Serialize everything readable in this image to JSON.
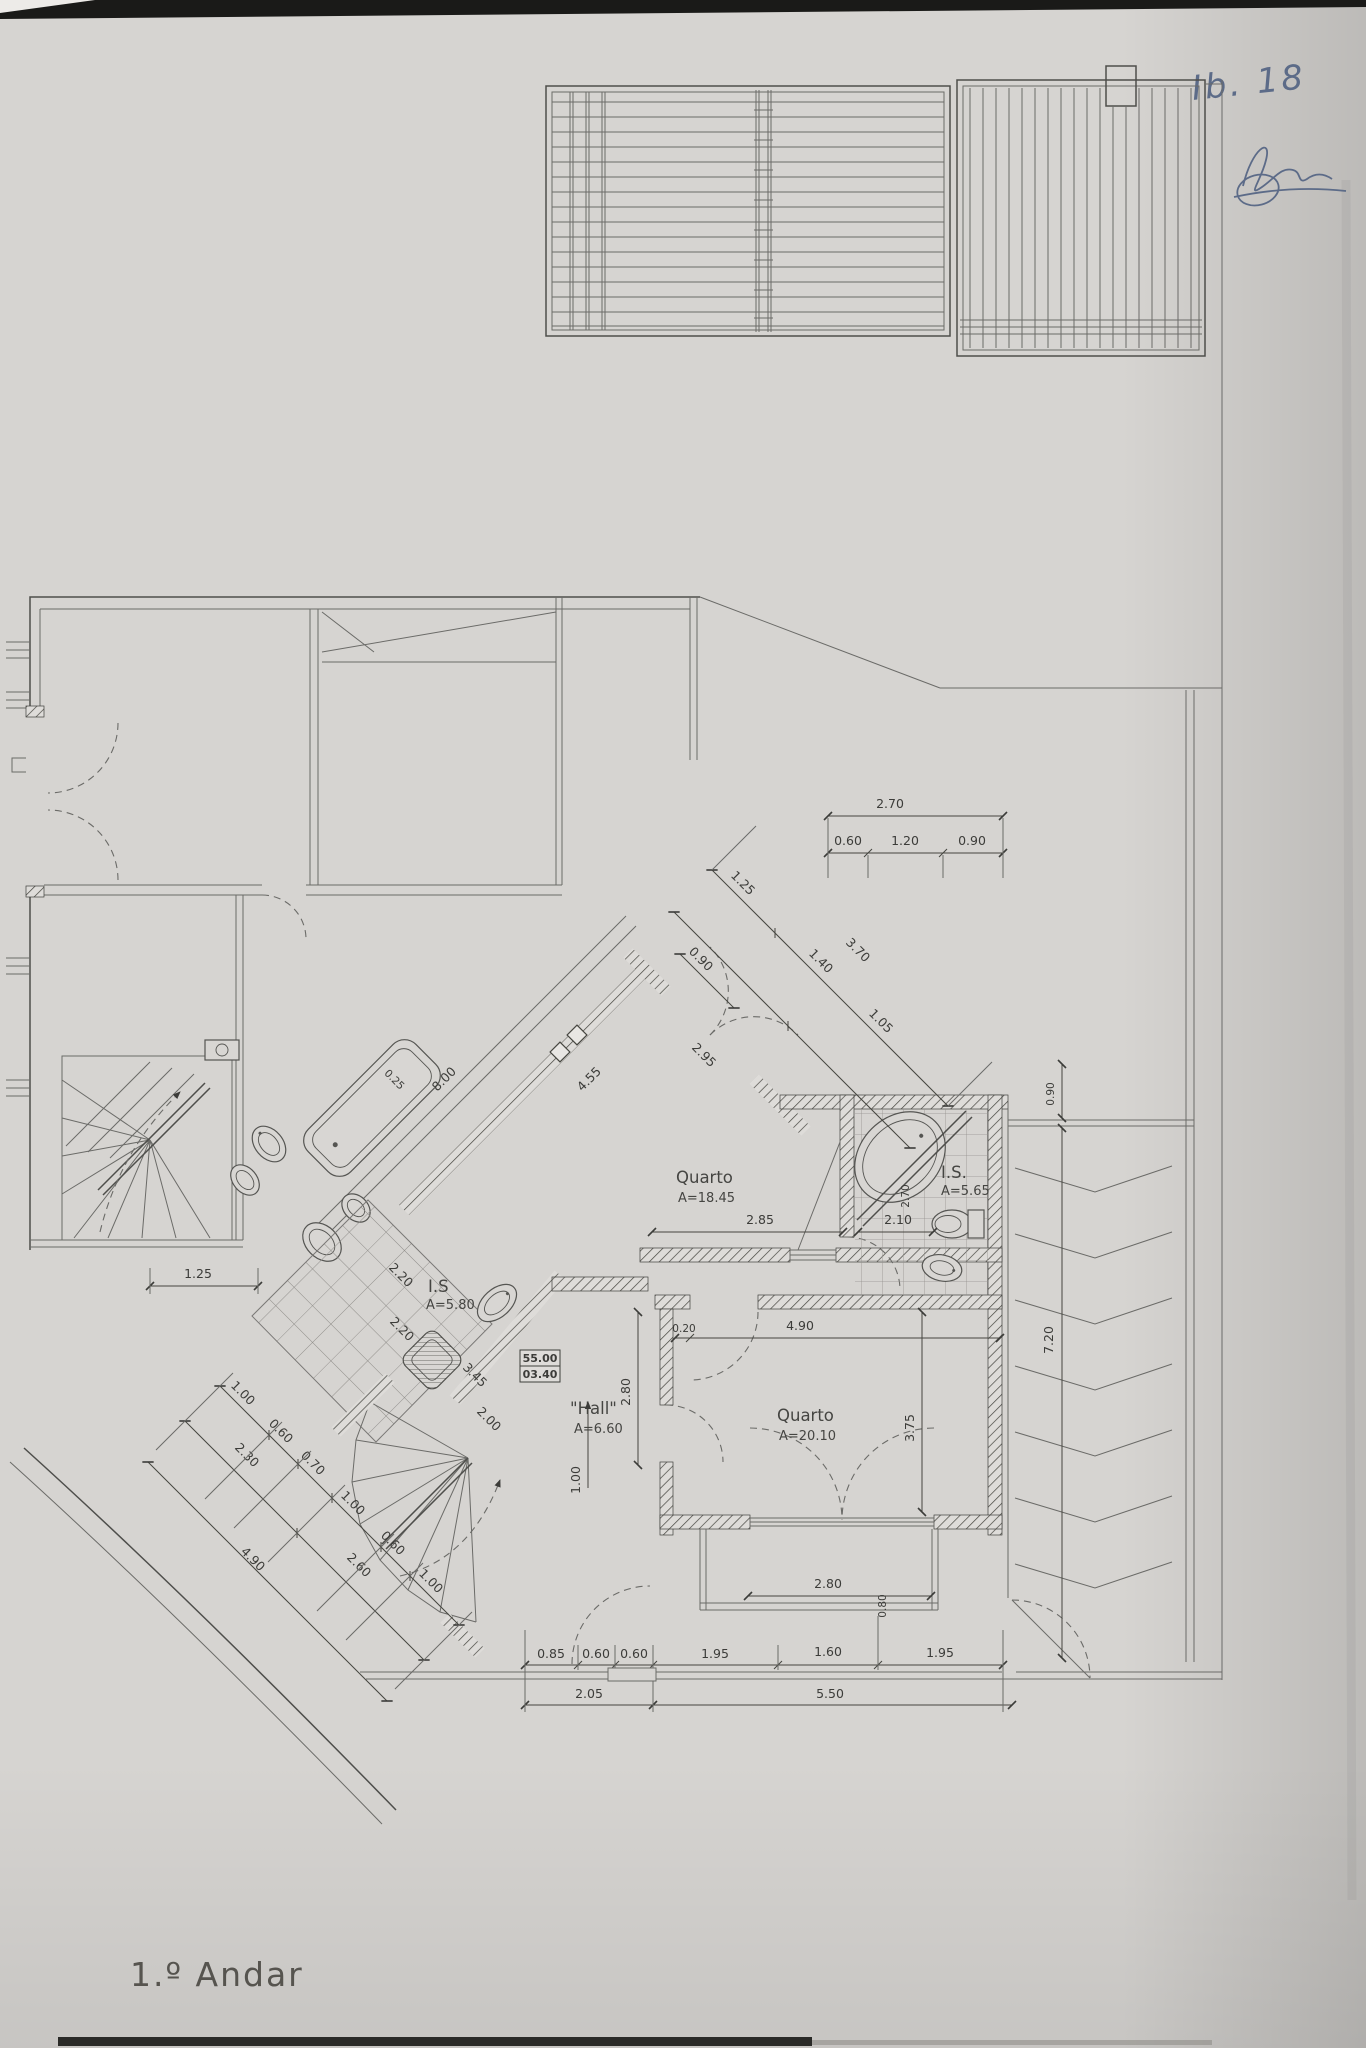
{
  "document": {
    "floor_label": "1.º Andar",
    "handwritten_note": "Ib. 18"
  },
  "rooms": {
    "quarto1": {
      "name": "Quarto",
      "area": "A=18.45"
    },
    "quarto2": {
      "name": "Quarto",
      "area": "A=20.10"
    },
    "is1": {
      "name": "I.S.",
      "area": "A=5.65"
    },
    "is2": {
      "name": "I.S",
      "area": "A=5.80"
    },
    "hall": {
      "name": "\"Hall\"",
      "area": "A=6.60"
    }
  },
  "level_marker": {
    "upper": "55.00",
    "lower": "03.40"
  },
  "dims": {
    "top": {
      "total": "2.70",
      "segs": [
        "0.60",
        "1.20",
        "0.90"
      ]
    },
    "diagonal": {
      "upper": [
        "1.25",
        "3.70"
      ],
      "lower": [
        "1.40",
        "1.05"
      ],
      "offset": "0.90"
    },
    "corridor": {
      "wall": "8.00",
      "inner": "4.55",
      "door": "2.95",
      "small": "0.25"
    },
    "quarto1_width": "2.85",
    "is1": {
      "width": "2.10",
      "height": "2.70"
    },
    "is2": {
      "a": "2.20",
      "b": "2.20"
    },
    "hall": {
      "height": "2.80",
      "leader": "1.00",
      "gap": "0.20",
      "width": "4.90",
      "wall": "3.45",
      "stair": "2.00"
    },
    "quarto2_height": "3.75",
    "ramp": {
      "offset": "0.90",
      "length": "7.20"
    },
    "balcony": {
      "width": "2.80",
      "depth": "0.80"
    },
    "bottom": {
      "row": [
        "0.85",
        "0.60",
        "0.60",
        "1.95",
        "1.60",
        "1.95"
      ],
      "left_total": "2.05",
      "right_total": "5.50"
    },
    "left": {
      "inner": [
        "1.00",
        "0.60",
        "0.70",
        "1.00",
        "0.60",
        "1.00"
      ],
      "mid": [
        "2.30",
        "2.60"
      ],
      "outer": "4.90",
      "door": "1.25"
    }
  }
}
